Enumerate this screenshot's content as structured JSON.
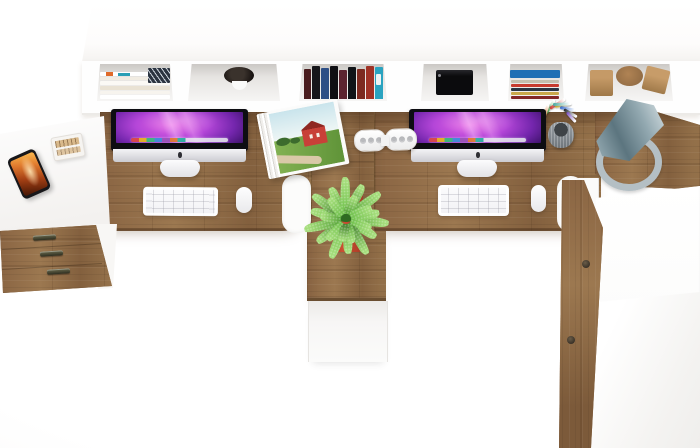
{
  "scene": {
    "kind": "product-photo",
    "subject": "Two-person office workstation with hutch shelf, viewed from directly above",
    "background": "white studio floor"
  },
  "colors": {
    "wood": "#8e6a45",
    "wood_light": "#9c7850",
    "wood_dark": "#6d5134",
    "panel": "#fdfdfd",
    "panel_line": "#e6e4e1",
    "shelf_interior_dark": "#cbc8c5",
    "shelf_interior_light": "#f6f5f4",
    "screen_pink": "#e565e4",
    "screen_violet": "#7426ad",
    "screen_deep": "#200a3c",
    "chin_silver": "#cbcbd1",
    "stand_white": "#e2e2e6",
    "keyboard_white": "#f1f1f4",
    "laptop_black": "#0b0b0d",
    "pot_red": "#a33823",
    "pot_red_light": "#cc4f33",
    "leaf_dark": "#3f7d2c",
    "leaf_mid": "#55a238",
    "leaf_light": "#6fc04c",
    "lamp_shade_dark": "#5c757f",
    "lamp_shade_light": "#cdd8dc",
    "lamp_ring": "#b4bfc4",
    "phone_body": "#17171a",
    "phone_flame_1": "#f7b14a",
    "phone_flame_2": "#a33f14",
    "socket_gray": "#b9babd",
    "barn_red": "#c84038",
    "field_green": "#83b253",
    "sky_blue": "#c9e4ec",
    "road_tan": "#d9c9a8",
    "handle_metal": "#2e2e20",
    "knob_dark": "#3a3228",
    "accent_orange": "#e06a28",
    "accent_teal": "#2a9fb5",
    "book_blue_cover": "#1f6fb5",
    "pen_cup_gray": "#6f767c"
  },
  "shelf": {
    "magazine_strips": [
      "#ffffff",
      "#f1ece2",
      "#fbf9f5",
      "#e9e2d4",
      "#f7f4ee",
      "#ffffff"
    ],
    "vertical_books": [
      {
        "color": "#4a1d1f",
        "h": 30
      },
      {
        "color": "#16161a",
        "h": 33
      },
      {
        "color": "#2d4f86",
        "h": 31
      },
      {
        "color": "#0f0f13",
        "h": 33
      },
      {
        "color": "#5c2430",
        "h": 29
      },
      {
        "color": "#101418",
        "h": 32
      },
      {
        "color": "#7d2a20",
        "h": 30
      },
      {
        "color": "#a03226",
        "h": 33
      },
      {
        "color": "#2aa3c0",
        "h": 32,
        "label": true
      }
    ],
    "stack_spines": [
      "#c4bfae",
      "#c73b2e",
      "#2a3542",
      "#caa84a",
      "#832727"
    ],
    "wood_decor": [
      "cube",
      "disc",
      "tilted-block"
    ]
  },
  "power_strip": {
    "segments": 2,
    "socket_x": [
      5,
      13,
      21
    ]
  },
  "pens": [
    {
      "c": "#3fae4a",
      "x": 6,
      "y": 12,
      "r": -58,
      "l": 16
    },
    {
      "c": "#d03b2f",
      "x": 10,
      "y": 7,
      "r": -32,
      "l": 18
    },
    {
      "c": "#e5c23a",
      "x": 15,
      "y": 5,
      "r": -10,
      "l": 17
    },
    {
      "c": "#3a6fd0",
      "x": 20,
      "y": 6,
      "r": 10,
      "l": 16
    },
    {
      "c": "#20242a",
      "x": 24,
      "y": 8,
      "r": 30,
      "l": 15
    },
    {
      "c": "#e07a2e",
      "x": 4,
      "y": 16,
      "r": -72,
      "l": 14
    },
    {
      "c": "#7a4fc0",
      "x": 27,
      "y": 11,
      "r": 48,
      "l": 13
    },
    {
      "c": "#49a89f",
      "x": 13,
      "y": 3,
      "r": -2,
      "l": 18
    }
  ],
  "plant": {
    "tones": [
      "#3f7d2c",
      "#55a238",
      "#6fc04c"
    ],
    "tip": "#a4dd7a",
    "leaves": [
      {
        "a": 5,
        "l": 38,
        "t": 1
      },
      {
        "a": 30,
        "l": 30,
        "t": 2
      },
      {
        "a": 58,
        "l": 36,
        "t": 0
      },
      {
        "a": 85,
        "l": 30,
        "t": 1
      },
      {
        "a": 110,
        "l": 37,
        "t": 2
      },
      {
        "a": 140,
        "l": 32,
        "t": 0
      },
      {
        "a": 165,
        "l": 38,
        "t": 1
      },
      {
        "a": 192,
        "l": 31,
        "t": 2
      },
      {
        "a": 215,
        "l": 36,
        "t": 0
      },
      {
        "a": 243,
        "l": 30,
        "t": 1
      },
      {
        "a": 268,
        "l": 37,
        "t": 2
      },
      {
        "a": 295,
        "l": 33,
        "t": 0
      },
      {
        "a": 322,
        "l": 38,
        "t": 1
      },
      {
        "a": 348,
        "l": 29,
        "t": 2
      },
      {
        "a": 20,
        "l": 22,
        "t": 2
      },
      {
        "a": 75,
        "l": 20,
        "t": 1
      },
      {
        "a": 130,
        "l": 23,
        "t": 2
      },
      {
        "a": 185,
        "l": 21,
        "t": 1
      },
      {
        "a": 230,
        "l": 22,
        "t": 2
      },
      {
        "a": 290,
        "l": 20,
        "t": 1
      },
      {
        "a": 335,
        "l": 23,
        "t": 2
      },
      {
        "a": 100,
        "l": 18,
        "t": 0
      }
    ]
  },
  "drawers": {
    "handles": [
      {
        "x": 33,
        "y": 13
      },
      {
        "x": 40,
        "y": 29
      },
      {
        "x": 47,
        "y": 47
      }
    ]
  },
  "cabinet": {
    "knobs": [
      {
        "x": 26,
        "y": 84
      },
      {
        "x": 11,
        "y": 160
      }
    ]
  }
}
